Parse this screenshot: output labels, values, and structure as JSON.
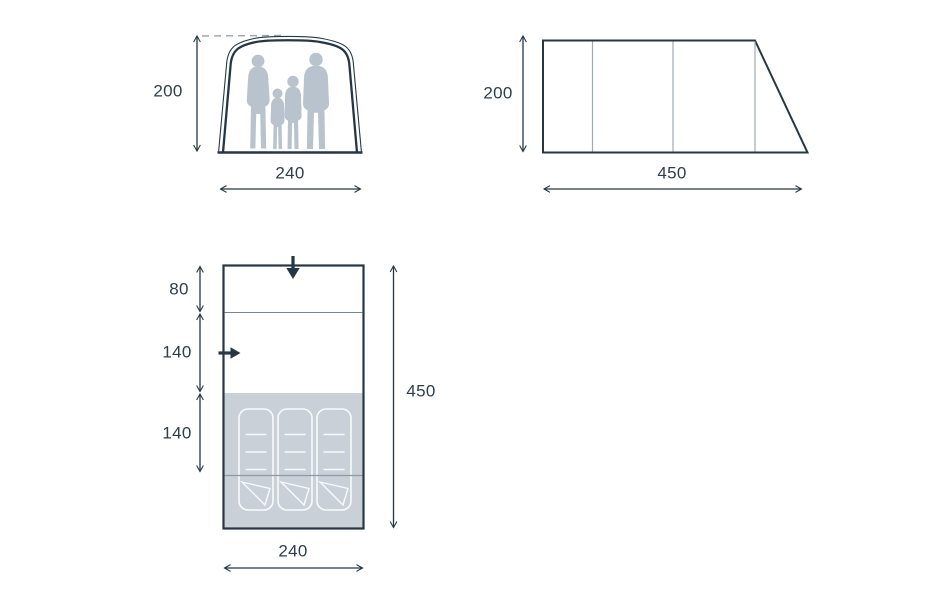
{
  "views": {
    "front": {
      "height": "200",
      "width": "240",
      "figures": "family-silhouette"
    },
    "side": {
      "height": "200",
      "length": "450"
    },
    "floorplan": {
      "section_depths": [
        "80",
        "140",
        "140"
      ],
      "total_depth": "450",
      "width": "240",
      "mat_count": 3,
      "icons": [
        "down-arrow",
        "right-arrow"
      ]
    }
  },
  "colors": {
    "outline": "#253745",
    "text": "#2e3e4e",
    "silhouette": "#b8c3ce",
    "floor_fill": "#c9d0d8",
    "divider_light": "#9fa9b3",
    "divider_plan": "#72889a",
    "divider_dark": "#8e99a4",
    "mat_stroke": "#f8fafb",
    "dashed_line": "#9aa4ae",
    "bg": "#ffffff"
  }
}
